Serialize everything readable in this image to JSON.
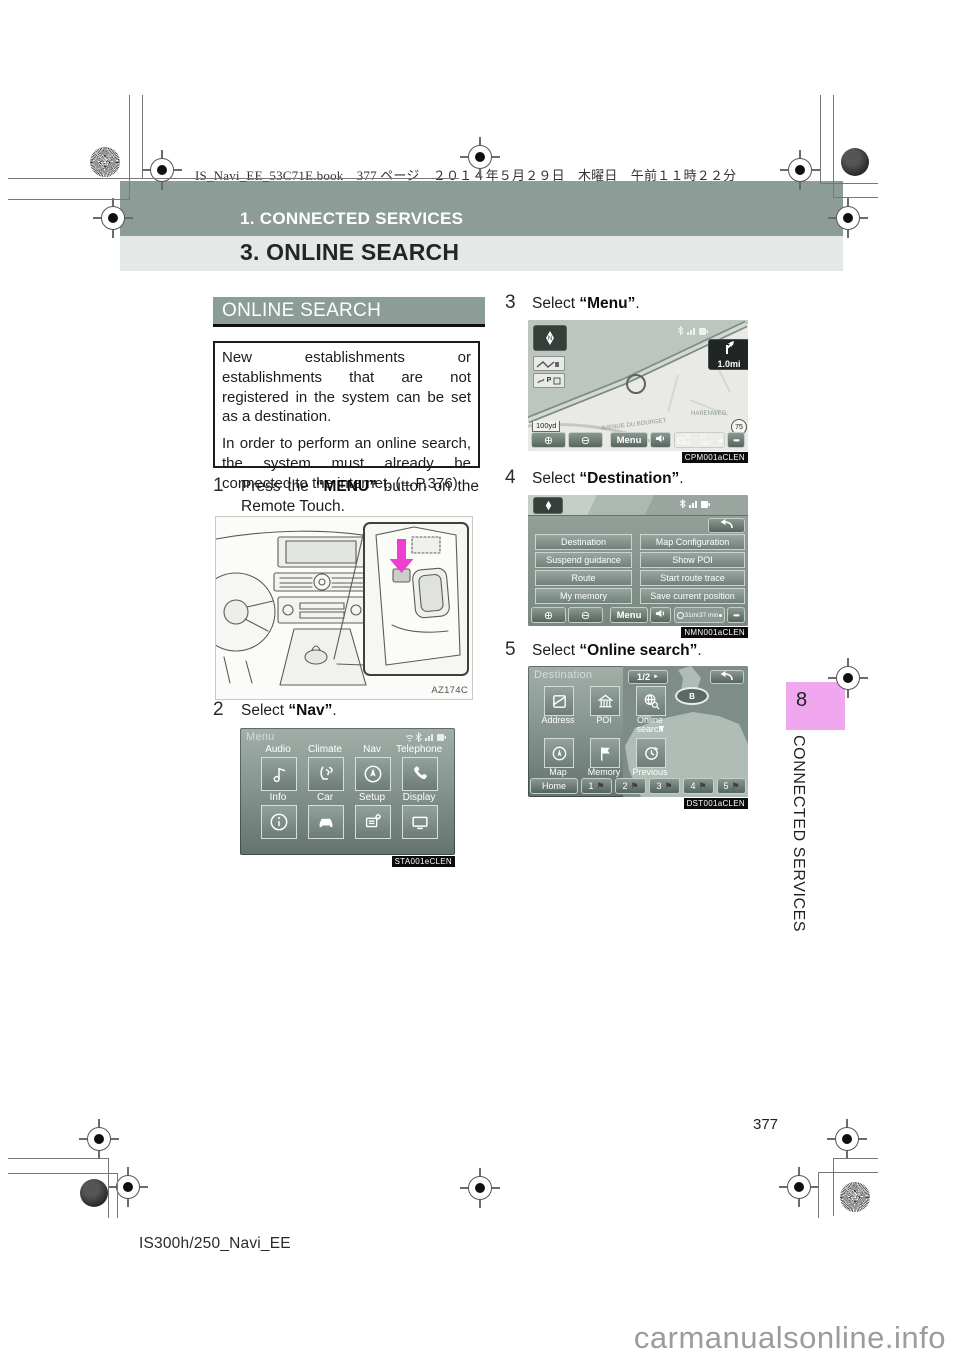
{
  "print_header": {
    "text": "IS_Navi_EE_53C71E.book　377 ページ　２０１４年５月２９日　木曜日　午前１１時２２分"
  },
  "chapter_bar": {
    "label": "1. CONNECTED SERVICES"
  },
  "section_bar": {
    "label": "3. ONLINE SEARCH"
  },
  "intro": {
    "title": "ONLINE SEARCH",
    "paragraphs": [
      "New establishments or establishments that are not registered in the system can be set as a destination.",
      "In order to perform an online search, the system must already be connected to the internet. (→P.376)"
    ]
  },
  "steps": [
    {
      "num": "1",
      "pre": "Press the ",
      "key": "“MENU”",
      "post": " button on the Remote Touch."
    },
    {
      "num": "2",
      "pre": "Select ",
      "key": "“Nav”",
      "post": "."
    },
    {
      "num": "3",
      "pre": "Select ",
      "key": "“Menu”",
      "post": "."
    },
    {
      "num": "4",
      "pre": "Select ",
      "key": "“Destination”",
      "post": "."
    },
    {
      "num": "5",
      "pre": "Select ",
      "key": "“Online search”",
      "post": "."
    }
  ],
  "figure": {
    "code": "AZ174C"
  },
  "chrome": {
    "zoom_in": "⊕",
    "zoom_out": "⊖"
  },
  "icons": {
    "flag": "⚑"
  },
  "menu_screen": {
    "title": "Menu",
    "tiles": [
      {
        "label": "Audio"
      },
      {
        "label": "Climate"
      },
      {
        "label": "Nav"
      },
      {
        "label": "Telephone"
      },
      {
        "label": "Info"
      },
      {
        "label": "Car"
      },
      {
        "label": "Setup"
      },
      {
        "label": "Display"
      }
    ],
    "code": "STA001eCLEN"
  },
  "map_screen": {
    "turn_distance": "1.0mi",
    "scale": "100yd",
    "streets": [
      "HARENWEG",
      "AVENUE DU BOURGET"
    ],
    "speed_sign": "75",
    "menu_button": "Menu",
    "distance": "31 mi",
    "time": "37 min",
    "more": "•••",
    "code": "CPM001aCLEN"
  },
  "nav_menu_screen": {
    "buttons": [
      "Destination",
      "Suspend guidance",
      "Route",
      "My memory",
      "Map Configuration",
      "Show POI",
      "Start route trace",
      "Save current position"
    ],
    "menu_button": "Menu",
    "distance": "31mi",
    "time": "37 min",
    "more": "•••",
    "code": "NMN001aCLEN"
  },
  "destination_screen": {
    "title": "Destination",
    "page_indicator": "1/2",
    "page_arrow": "►",
    "tiles": [
      "Address",
      "POI",
      "Online search",
      "Map",
      "Memory",
      "Previous"
    ],
    "b_badge": "B",
    "home_button": "Home",
    "presets": [
      "1",
      "2",
      "3",
      "4",
      "5"
    ],
    "code": "DST001aCLEN"
  },
  "side_tab": {
    "number": "8",
    "label": "CONNECTED SERVICES",
    "color": "#f0a7ef"
  },
  "footer": {
    "page_number": "377",
    "doc_id": "IS300h/250_Navi_EE",
    "watermark": "carmanualsonline.info"
  }
}
